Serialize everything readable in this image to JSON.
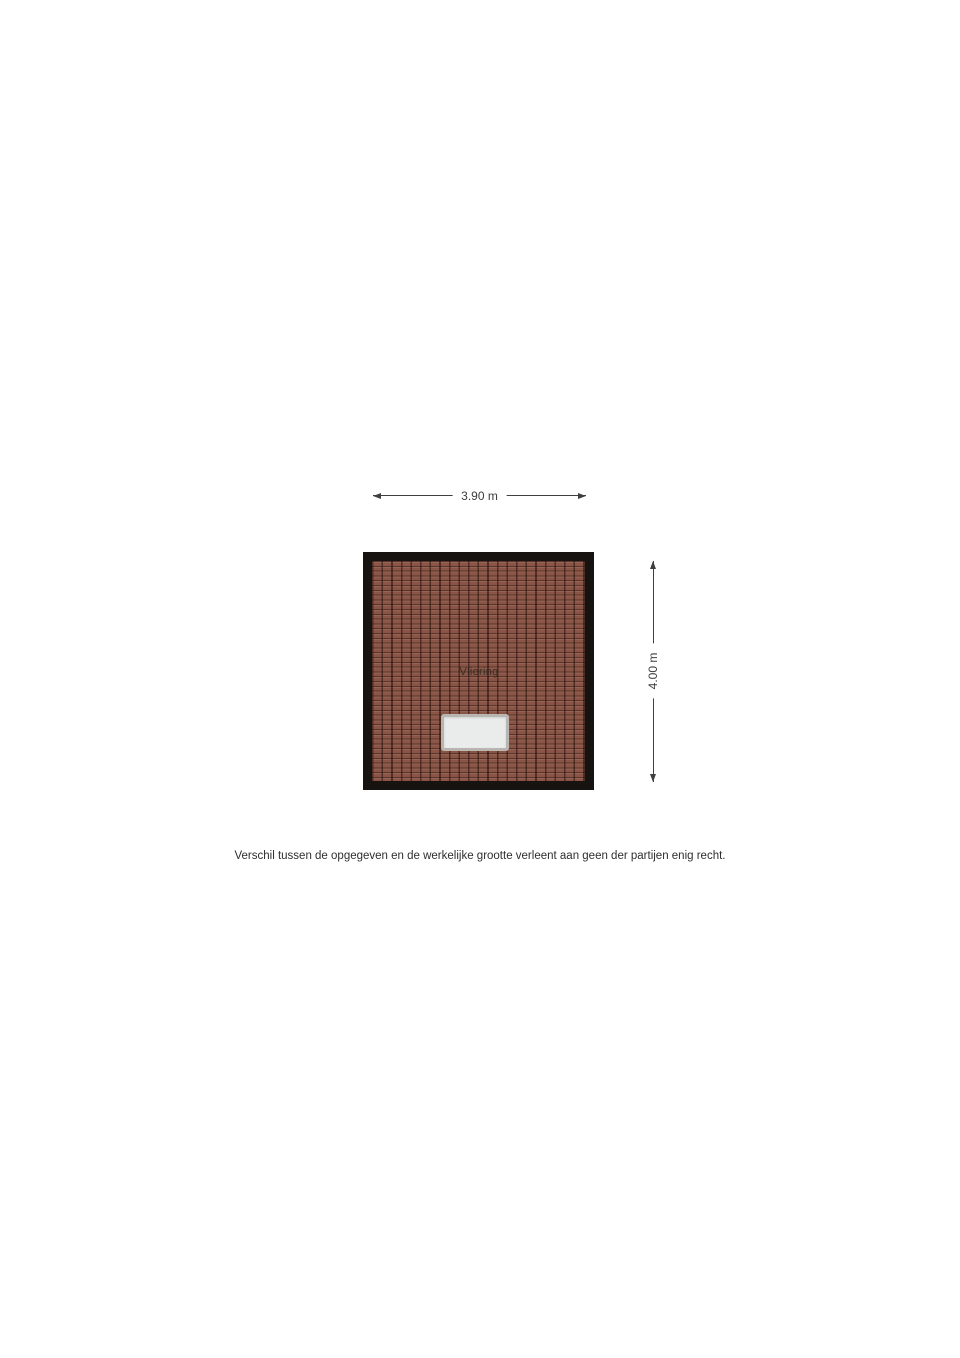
{
  "floorplan": {
    "room": {
      "label": "Vliering",
      "width_label": "3.90 m",
      "height_label": "4.00 m"
    },
    "colors": {
      "background": "#ffffff",
      "wall": "#171310",
      "tile_base": "#8a5546",
      "tile_grout": "#2e160f",
      "hatch_frame": "#b9b6b2",
      "hatch_fill": "#eaeceb",
      "dimension_line": "#3f3f3f",
      "dimension_text": "#3c3c3c",
      "label_text": "#30291f",
      "disclaimer_text": "#2e2e2e"
    }
  },
  "footer": {
    "disclaimer": "Verschil tussen de opgegeven en de werkelijke grootte verleent aan geen der partijen enig recht."
  }
}
